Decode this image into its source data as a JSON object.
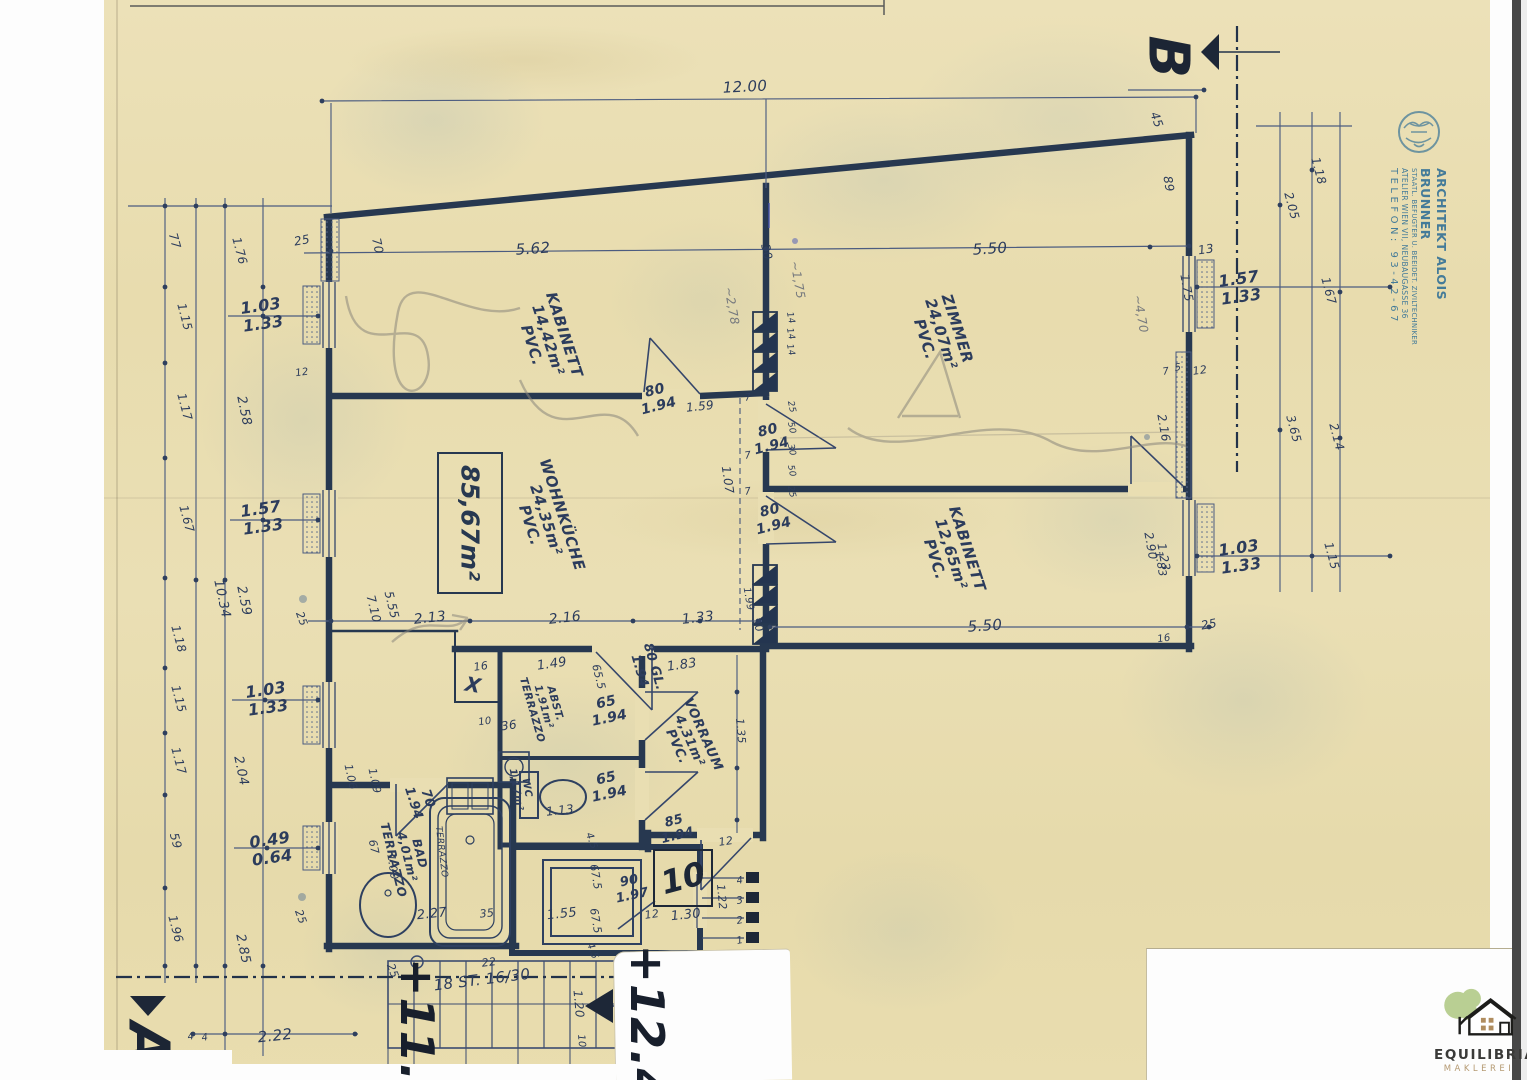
{
  "stamp": {
    "line1": "ARCHITEKT ALOIS BRUNNER",
    "line2": "STAATL. BEFUGTER U. BEEIDET. ZIVILTECHNIKER",
    "line3": "ATELIER WIEN VII, NEUBAUGASSE 36",
    "line4": "TELEFON: 93-42-67"
  },
  "markers": {
    "b": {
      "t": "B",
      "x": 1167,
      "y": 57
    },
    "a": {
      "t": "A",
      "x": 147,
      "y": 1044
    }
  },
  "area_box": {
    "text": "85,67m²"
  },
  "apartment": {
    "number": "10"
  },
  "stairs": {
    "label": "18 ST. 16/30",
    "x": 482,
    "y": 980,
    "correction": "22",
    "cx": 489,
    "cy": 963
  },
  "elevations": [
    {
      "t": "+11.",
      "x": 416,
      "y": 1020
    },
    {
      "t": "+12.4",
      "x": 646,
      "y": 1023
    }
  ],
  "logo": {
    "name": "EQUILIBRIA",
    "tagline": "MAKLEREI"
  },
  "rooms": [
    {
      "name": "KABINETT",
      "area": "14,42m²",
      "floor": "PVC.",
      "x": 548,
      "y": 340,
      "r": 72,
      "s": 15
    },
    {
      "name": "ZIMMER",
      "area": "24,07m²",
      "floor": "PVC.",
      "x": 941,
      "y": 334,
      "r": 72,
      "s": 15
    },
    {
      "name": "WOHNKÜCHE",
      "area": "24,35m²",
      "floor": "PVC.",
      "x": 546,
      "y": 520,
      "r": 72,
      "s": 15
    },
    {
      "name": "KABINETT",
      "area": "12,65m²",
      "floor": "PVC.",
      "x": 951,
      "y": 554,
      "r": 72,
      "s": 15
    },
    {
      "name": "VORRAUM",
      "area": "4,31m²",
      "floor": "PVC.",
      "x": 689,
      "y": 741,
      "r": 66,
      "s": 13
    },
    {
      "name": "ABST.",
      "area": "1,91m²",
      "floor": "TERRAZZO",
      "x": 543,
      "y": 707,
      "r": 74,
      "s": 10.5
    },
    {
      "name": "WC",
      "area": "1,17m²",
      "floor": "",
      "x": 521,
      "y": 789,
      "r": 80,
      "s": 10
    },
    {
      "name": "BAD",
      "area": "4,01m²",
      "floor": "TERRAZZO",
      "x": 406,
      "y": 857,
      "r": 76,
      "s": 12
    }
  ],
  "doors": [
    {
      "t": "80\n1.94",
      "x": 657,
      "y": 399,
      "r": -14,
      "s": 14
    },
    {
      "t": "80\n1.94",
      "x": 770,
      "y": 439,
      "r": -14,
      "s": 14
    },
    {
      "t": "80\n1.94",
      "x": 772,
      "y": 519,
      "r": -14,
      "s": 14
    },
    {
      "t": "80 GL.\n1.94",
      "x": 646,
      "y": 669,
      "r": 74,
      "s": 13
    },
    {
      "t": "65\n1.94",
      "x": 608,
      "y": 711,
      "r": -12,
      "s": 14
    },
    {
      "t": "65\n1.94",
      "x": 608,
      "y": 787,
      "r": -12,
      "s": 14
    },
    {
      "t": "85\n1.94",
      "x": 676,
      "y": 829,
      "r": -14,
      "s": 13
    },
    {
      "t": "90\n1.97",
      "x": 631,
      "y": 889,
      "r": -12,
      "s": 13
    },
    {
      "t": "70\n1.94",
      "x": 420,
      "y": 801,
      "r": 72,
      "s": 13
    }
  ],
  "dims": [
    {
      "t": "12.00",
      "x": 745,
      "y": 87,
      "r": -3,
      "s": 15
    },
    {
      "t": "5.62",
      "x": 533,
      "y": 249,
      "r": -4,
      "s": 15
    },
    {
      "t": "5.50",
      "x": 990,
      "y": 249,
      "r": -4,
      "s": 15
    },
    {
      "t": "25",
      "x": 302,
      "y": 241,
      "r": -10,
      "s": 12
    },
    {
      "t": "70",
      "x": 377,
      "y": 246,
      "r": 78,
      "s": 12
    },
    {
      "t": "30",
      "x": 766,
      "y": 252,
      "r": 78,
      "s": 12
    },
    {
      "t": "~2,78",
      "x": 731,
      "y": 306,
      "r": 80,
      "s": 12,
      "c": 1
    },
    {
      "t": "~1,75",
      "x": 797,
      "y": 280,
      "r": 80,
      "s": 12,
      "c": 1
    },
    {
      "t": "14",
      "x": 790,
      "y": 318,
      "r": 78,
      "s": 9
    },
    {
      "t": "14",
      "x": 790,
      "y": 334,
      "r": 78,
      "s": 9
    },
    {
      "t": "14",
      "x": 790,
      "y": 350,
      "r": 78,
      "s": 9
    },
    {
      "t": "~4,70",
      "x": 1140,
      "y": 314,
      "r": 80,
      "s": 12,
      "c": 1
    },
    {
      "t": "1.75",
      "x": 1186,
      "y": 288,
      "r": 80,
      "s": 12
    },
    {
      "t": "45",
      "x": 1156,
      "y": 120,
      "r": 70,
      "s": 12
    },
    {
      "t": "89",
      "x": 1168,
      "y": 184,
      "r": 80,
      "s": 12
    },
    {
      "t": "13",
      "x": 1206,
      "y": 250,
      "r": -8,
      "s": 12
    },
    {
      "t": "1.18",
      "x": 1318,
      "y": 171,
      "r": 75,
      "s": 12
    },
    {
      "t": "2.05",
      "x": 1291,
      "y": 206,
      "r": 75,
      "s": 12
    },
    {
      "t": "1.67",
      "x": 1328,
      "y": 291,
      "r": 75,
      "s": 12
    },
    {
      "t": "3.65",
      "x": 1293,
      "y": 429,
      "r": 75,
      "s": 12
    },
    {
      "t": "2.14",
      "x": 1336,
      "y": 437,
      "r": 75,
      "s": 12
    },
    {
      "t": "1.15",
      "x": 1331,
      "y": 556,
      "r": 75,
      "s": 12
    },
    {
      "t": "1.57\n1.33",
      "x": 1240,
      "y": 288,
      "r": -8,
      "s": 16,
      "w": 1
    },
    {
      "t": "1.03\n1.33",
      "x": 1240,
      "y": 557,
      "r": -8,
      "s": 16,
      "w": 1
    },
    {
      "t": "2.16",
      "x": 1163,
      "y": 428,
      "r": 80,
      "s": 12
    },
    {
      "t": "1.23",
      "x": 1163,
      "y": 557,
      "r": 80,
      "s": 12
    },
    {
      "t": "2.90",
      "x": 1150,
      "y": 546,
      "r": 80,
      "s": 12
    },
    {
      "t": "1.83",
      "x": 1160,
      "y": 564,
      "r": 80,
      "s": 11
    },
    {
      "t": "12",
      "x": 1200,
      "y": 371,
      "r": -8,
      "s": 11
    },
    {
      "t": "5",
      "x": 1178,
      "y": 368,
      "r": -8,
      "s": 10
    },
    {
      "t": "7",
      "x": 1166,
      "y": 372,
      "r": -8,
      "s": 10
    },
    {
      "t": "5.50",
      "x": 985,
      "y": 626,
      "r": -4,
      "s": 15
    },
    {
      "t": "25",
      "x": 1209,
      "y": 625,
      "r": -10,
      "s": 12
    },
    {
      "t": "16",
      "x": 1164,
      "y": 639,
      "r": -8,
      "s": 10
    },
    {
      "t": "77",
      "x": 174,
      "y": 241,
      "r": 75,
      "s": 12
    },
    {
      "t": "1.76",
      "x": 239,
      "y": 251,
      "r": 75,
      "s": 12
    },
    {
      "t": "1.15",
      "x": 184,
      "y": 317,
      "r": 75,
      "s": 12
    },
    {
      "t": "1.17",
      "x": 184,
      "y": 407,
      "r": 75,
      "s": 12
    },
    {
      "t": "1.67",
      "x": 186,
      "y": 519,
      "r": 75,
      "s": 12
    },
    {
      "t": "1.18",
      "x": 178,
      "y": 639,
      "r": 75,
      "s": 12
    },
    {
      "t": "1.15",
      "x": 178,
      "y": 699,
      "r": 75,
      "s": 12
    },
    {
      "t": "1.17",
      "x": 178,
      "y": 761,
      "r": 75,
      "s": 12
    },
    {
      "t": "59",
      "x": 175,
      "y": 841,
      "r": 75,
      "s": 12
    },
    {
      "t": "1.96",
      "x": 175,
      "y": 929,
      "r": 75,
      "s": 12
    },
    {
      "t": "2.58",
      "x": 243,
      "y": 411,
      "r": 78,
      "s": 13
    },
    {
      "t": "10.34",
      "x": 221,
      "y": 599,
      "r": 78,
      "s": 13
    },
    {
      "t": "2.59",
      "x": 243,
      "y": 601,
      "r": 78,
      "s": 13
    },
    {
      "t": "2.04",
      "x": 240,
      "y": 771,
      "r": 78,
      "s": 13
    },
    {
      "t": "2.85",
      "x": 242,
      "y": 949,
      "r": 78,
      "s": 13
    },
    {
      "t": "1.03\n1.33",
      "x": 262,
      "y": 315,
      "r": -8,
      "s": 16,
      "w": 1
    },
    {
      "t": "1.57\n1.33",
      "x": 262,
      "y": 518,
      "r": -8,
      "s": 16,
      "w": 1
    },
    {
      "t": "1.03\n1.33",
      "x": 267,
      "y": 699,
      "r": -8,
      "s": 16,
      "w": 1
    },
    {
      "t": "0.49\n0.64",
      "x": 271,
      "y": 849,
      "r": -8,
      "s": 16,
      "w": 1
    },
    {
      "t": "12",
      "x": 302,
      "y": 373,
      "r": -8,
      "s": 10
    },
    {
      "t": "25",
      "x": 301,
      "y": 619,
      "r": 70,
      "s": 11
    },
    {
      "t": "25",
      "x": 300,
      "y": 917,
      "r": 70,
      "s": 11
    },
    {
      "t": "2.22",
      "x": 275,
      "y": 1036,
      "r": -6,
      "s": 15
    },
    {
      "t": "4",
      "x": 191,
      "y": 1037,
      "r": -8,
      "s": 10
    },
    {
      "t": "4",
      "x": 205,
      "y": 1038,
      "r": -8,
      "s": 10
    },
    {
      "t": "1.59",
      "x": 700,
      "y": 407,
      "r": -6,
      "s": 12
    },
    {
      "t": "1.07",
      "x": 727,
      "y": 480,
      "r": 82,
      "s": 12
    },
    {
      "t": "7",
      "x": 748,
      "y": 398,
      "r": -8,
      "s": 10
    },
    {
      "t": "7",
      "x": 748,
      "y": 456,
      "r": -8,
      "s": 10
    },
    {
      "t": "7",
      "x": 748,
      "y": 492,
      "r": -8,
      "s": 10
    },
    {
      "t": "25",
      "x": 791,
      "y": 407,
      "r": 78,
      "s": 9
    },
    {
      "t": "50",
      "x": 791,
      "y": 428,
      "r": 78,
      "s": 9
    },
    {
      "t": "30",
      "x": 791,
      "y": 450,
      "r": 78,
      "s": 9
    },
    {
      "t": "50",
      "x": 791,
      "y": 471,
      "r": 78,
      "s": 9
    },
    {
      "t": "25",
      "x": 791,
      "y": 492,
      "r": 78,
      "s": 9
    },
    {
      "t": "1.99",
      "x": 748,
      "y": 599,
      "r": 80,
      "s": 10
    },
    {
      "t": "30",
      "x": 757,
      "y": 625,
      "r": 70,
      "s": 11
    },
    {
      "t": "2.13",
      "x": 430,
      "y": 619,
      "r": -6,
      "s": 14
    },
    {
      "t": "2.16",
      "x": 565,
      "y": 619,
      "r": -6,
      "s": 14
    },
    {
      "t": "1.33",
      "x": 698,
      "y": 619,
      "r": -6,
      "s": 14
    },
    {
      "t": "5.55",
      "x": 391,
      "y": 605,
      "r": 76,
      "s": 12
    },
    {
      "t": "7.10",
      "x": 373,
      "y": 609,
      "r": 76,
      "s": 12
    },
    {
      "t": "1.49",
      "x": 552,
      "y": 665,
      "r": -8,
      "s": 13
    },
    {
      "t": "16",
      "x": 481,
      "y": 667,
      "r": -8,
      "s": 11
    },
    {
      "t": "65.5",
      "x": 598,
      "y": 677,
      "r": 76,
      "s": 11
    },
    {
      "t": "1.83",
      "x": 682,
      "y": 666,
      "r": -8,
      "s": 13
    },
    {
      "t": "X",
      "x": 473,
      "y": 685,
      "r": 10,
      "s": 20,
      "w": 1
    },
    {
      "t": "36",
      "x": 509,
      "y": 726,
      "r": -8,
      "s": 12
    },
    {
      "t": "10",
      "x": 485,
      "y": 722,
      "r": -8,
      "s": 10
    },
    {
      "t": "1.35",
      "x": 740,
      "y": 731,
      "r": 85,
      "s": 11
    },
    {
      "t": "1.13",
      "x": 560,
      "y": 811,
      "r": -6,
      "s": 12
    },
    {
      "t": "1.06",
      "x": 350,
      "y": 777,
      "r": 78,
      "s": 11
    },
    {
      "t": "1.09",
      "x": 374,
      "y": 781,
      "r": 78,
      "s": 11
    },
    {
      "t": "1.00",
      "x": 392,
      "y": 867,
      "r": 82,
      "s": 11
    },
    {
      "t": "67",
      "x": 373,
      "y": 847,
      "r": 78,
      "s": 11
    },
    {
      "t": "TERRAZZO",
      "x": 441,
      "y": 852,
      "r": 83,
      "s": 9
    },
    {
      "t": "2.27",
      "x": 432,
      "y": 915,
      "r": -6,
      "s": 13
    },
    {
      "t": "35",
      "x": 487,
      "y": 914,
      "r": -6,
      "s": 11
    },
    {
      "t": "1.55",
      "x": 562,
      "y": 915,
      "r": -6,
      "s": 13
    },
    {
      "t": "67.5",
      "x": 595,
      "y": 877,
      "r": 80,
      "s": 11
    },
    {
      "t": "67.5",
      "x": 595,
      "y": 921,
      "r": 80,
      "s": 11
    },
    {
      "t": "4.5",
      "x": 591,
      "y": 841,
      "r": 70,
      "s": 10
    },
    {
      "t": "4.5",
      "x": 592,
      "y": 951,
      "r": 70,
      "s": 10
    },
    {
      "t": "12",
      "x": 726,
      "y": 842,
      "r": -8,
      "s": 11
    },
    {
      "t": "1.22",
      "x": 721,
      "y": 897,
      "r": 85,
      "s": 11
    },
    {
      "t": "12",
      "x": 652,
      "y": 915,
      "r": -8,
      "s": 11
    },
    {
      "t": "1.30",
      "x": 686,
      "y": 916,
      "r": -6,
      "s": 13
    },
    {
      "t": "4",
      "x": 740,
      "y": 881,
      "r": -10,
      "s": 10
    },
    {
      "t": "3",
      "x": 740,
      "y": 901,
      "r": -10,
      "s": 10
    },
    {
      "t": "2",
      "x": 740,
      "y": 921,
      "r": -10,
      "s": 10
    },
    {
      "t": "1",
      "x": 740,
      "y": 941,
      "r": -10,
      "s": 10
    },
    {
      "t": "25",
      "x": 392,
      "y": 971,
      "r": 70,
      "s": 11
    },
    {
      "t": "1.20",
      "x": 578,
      "y": 1004,
      "r": 85,
      "s": 12
    },
    {
      "t": "10",
      "x": 581,
      "y": 1041,
      "r": 85,
      "s": 10
    }
  ],
  "colors": {
    "ink": "#2c3c5c",
    "wall": "#273850",
    "stamp": "#2e6e96",
    "paper": "#eadfb4",
    "pencil": "#8a867c",
    "logo_green": "#b9cf93",
    "logo_tan": "#b59a72"
  }
}
